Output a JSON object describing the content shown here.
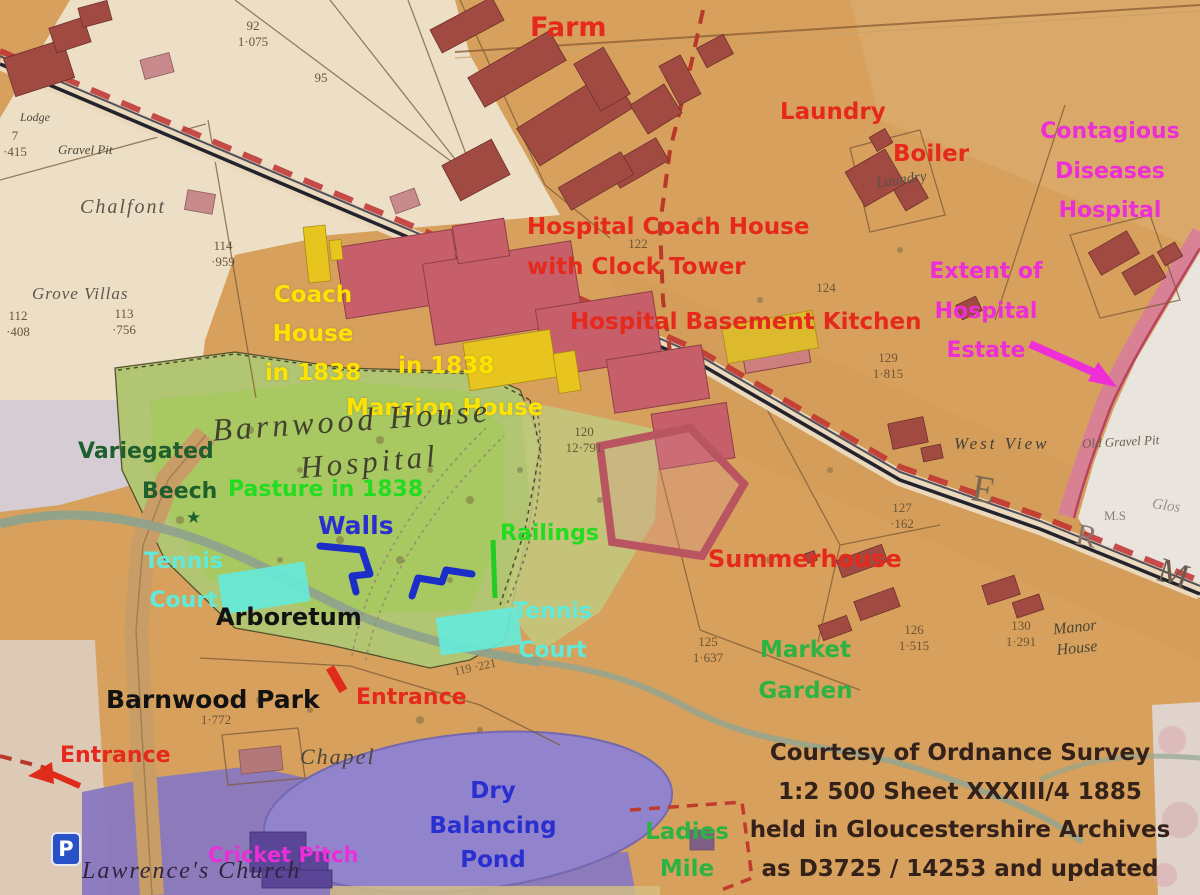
{
  "annotations": {
    "farm": "Farm",
    "laundry": "Laundry",
    "boiler": "Boiler",
    "hospital_coach_house": "Hospital Coach House\nwith Clock Tower",
    "hospital_basement_kitchen": "Hospital Basement Kitchen",
    "contagious": "Contagious\nDiseases\nHospital",
    "extent_of_estate": "Extent of\nHospital\nEstate",
    "coach_house_1838": "Coach\nHouse\nin 1838",
    "in_1838": "in 1838",
    "mansion_house": "Mansion House",
    "variegated": "Variegated",
    "beech": "Beech",
    "star": "★",
    "pasture_in_1838": "Pasture in 1838",
    "walls": "Walls",
    "railings": "Railings",
    "summerhouse": "Summerhouse",
    "tennis_court_left": "Tennis\nCourt",
    "tennis_court_right": "Tennis\nCourt",
    "arboretum": "Arboretum",
    "barnwood_park": "Barnwood Park",
    "entrance_mid": "Entrance",
    "entrance_left": "Entrance",
    "market_garden": "Market\nGarden",
    "cricket_pitch": "Cricket Pitch",
    "dry_balancing_pond": "Dry\nBalancing\nPond",
    "ladies_mile": "Ladies\nMile"
  },
  "map_text": {
    "barnwood_house": "Barnwood House",
    "hospital_script": "Hospital",
    "chalfont": "Chalfont",
    "grove_villas": "Grove Villas",
    "lodge": "Lodge",
    "gravel_pit": "Gravel Pit",
    "laundry_small": "Laundry",
    "west_view": "West View",
    "old_gravel_pit": "Old Gravel Pit",
    "chapel": "Chapel",
    "lawrences_church": "Lawrence's Church",
    "manor_house": "Manor\nHouse",
    "m_s": "M.S",
    "glos": "Glos",
    "letter_e": "E",
    "letter_r": "R",
    "letter_m": "M"
  },
  "parcels": {
    "p92": "92\n1·075",
    "p95": "95",
    "p117": "7\n·415",
    "p114": "114\n·959",
    "p113": "113\n·756",
    "p112": "112\n·408",
    "p122": "122",
    "p124": "124",
    "p129": "129\n1·815",
    "p120": "120\n12·791",
    "p127": "127\n·162",
    "p125": "125\n1·637",
    "p126": "126\n1·515",
    "p130": "130\n1·291",
    "p119": "119 ·221",
    "park_area": "1·772"
  },
  "credit": "Courtesy of Ordnance Survey\n1:2 500 Sheet XXXIII/4 1885\nheld in Gloucestershire Archives\nas D3725 / 14253 and updated",
  "icons": {
    "parking": "P"
  },
  "colors": {
    "annotation_red": "#e5291c",
    "annotation_magenta": "#ec2ed6",
    "annotation_yellow": "#fde303",
    "annotation_green_bright": "#23dc1f",
    "annotation_green_mid": "#2db344",
    "annotation_green_dark": "#1e5f2d",
    "annotation_cyan": "#5feadb",
    "annotation_blue": "#2a2fd0",
    "credit_brown": "#34211a",
    "map_tan": "#d7a05c",
    "pasture_green": "#b2c572",
    "park_purple": "#8878c0",
    "building_maroon": "#a04a42",
    "building_pink": "#c75f6a",
    "highlight_yellow": "#e7c51e",
    "tennis_cyan": "#66e9d9",
    "railway_red": "#c03030"
  }
}
